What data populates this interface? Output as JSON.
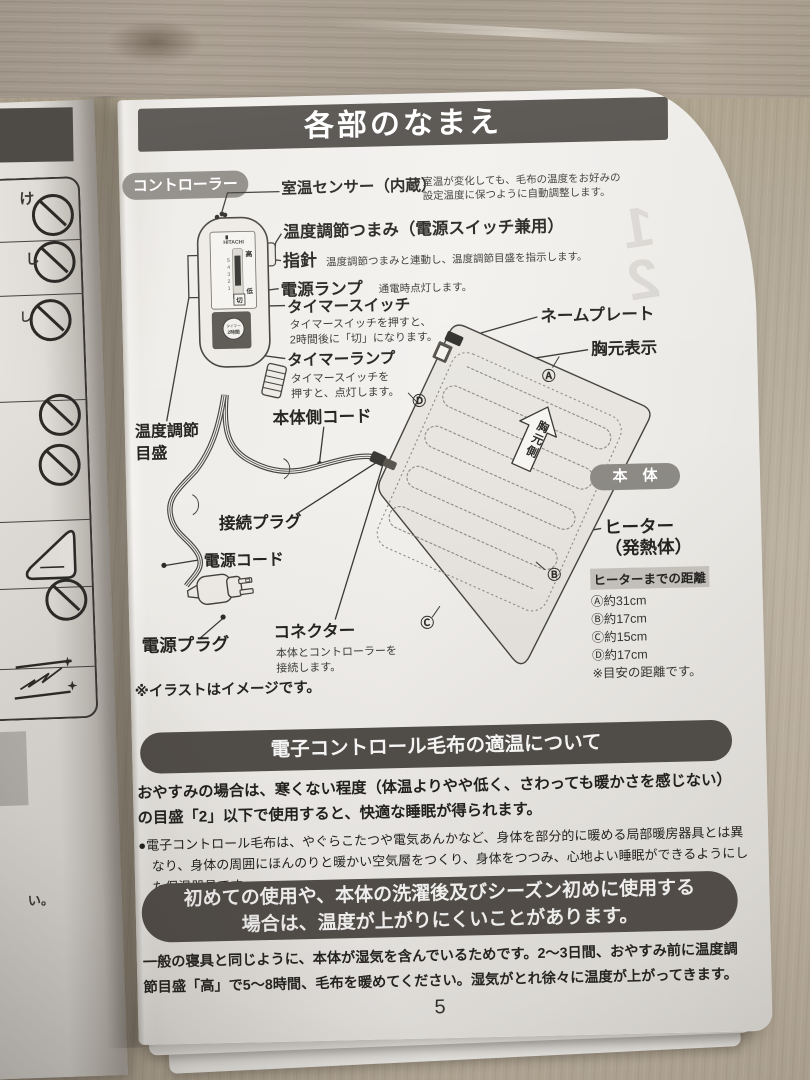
{
  "page": {
    "title": "各部のなまえ",
    "page_number": "5",
    "illustration_note": "※イラストはイメージです。",
    "ghost_digit_1": "1",
    "ghost_digit_2": "2"
  },
  "left_page": {
    "fragment_1": "け",
    "fragment_2": "し",
    "fragment_3": "し",
    "fragment_4": "い。"
  },
  "controller": {
    "badge": "コントローラー",
    "device": {
      "brand": "HITACHI",
      "scale_high": "高",
      "scale_low": "低",
      "scale_off": "切",
      "scale_numbers": [
        "5",
        "4",
        "3",
        "2",
        "1"
      ],
      "timer_button_line1": "タイマー",
      "timer_button_line2": "2時間"
    },
    "parts": {
      "room_sensor": {
        "name": "室温センサー（内蔵）",
        "desc": "室温が変化しても、毛布の温度をお好みの\n設定温度に保つように自動調整します。"
      },
      "temp_knob": {
        "name": "温度調節つまみ（電源スイッチ兼用）"
      },
      "pointer": {
        "name": "指針",
        "desc": "温度調節つまみと連動し、温度調節目盛を指示します。"
      },
      "power_lamp": {
        "name": "電源ランプ",
        "desc": "通電時点灯します。"
      },
      "timer_switch": {
        "name": "タイマースイッチ",
        "desc": "タイマースイッチを押すと、\n2時間後に「切」になります。"
      },
      "timer_lamp": {
        "name": "タイマーランプ",
        "desc": "タイマースイッチを\n押すと、点灯します。"
      },
      "temp_scale": {
        "name": "温度調節\n目盛"
      },
      "body_cord": {
        "name": "本体側コード"
      },
      "connect_plug": {
        "name": "接続プラグ"
      },
      "power_cord": {
        "name": "電源コード"
      },
      "power_plug": {
        "name": "電源プラグ"
      },
      "connector": {
        "name": "コネクター",
        "desc": "本体とコントローラーを\n接続します。"
      }
    }
  },
  "blanket": {
    "badge": "本　体",
    "parts": {
      "nameplate": "ネームプレート",
      "chest_mark": "胸元表示",
      "chest_side_arrow": "胸元側",
      "heater": "ヒーター\n（発熱体）"
    },
    "markers": {
      "a": "Ⓐ",
      "b": "Ⓑ",
      "c": "Ⓒ",
      "d": "Ⓓ"
    },
    "distances": {
      "title": "ヒーターまでの距離",
      "items": [
        "Ⓐ約31cm",
        "Ⓑ約17cm",
        "Ⓒ約15cm",
        "Ⓓ約17cm"
      ],
      "note": "※目安の距離です。"
    }
  },
  "info_sections": {
    "suitable_temp": {
      "title": "電子コントロール毛布の適温について",
      "paragraph": "おやすみの場合は、寒くない程度（体温よりやや低く、さわっても暖かさを感じない）の目盛「2」以下で使用すると、快適な睡眠が得られます。",
      "bullet": "●電子コントロール毛布は、やぐらこたつや電気あんかなど、身体を部分的に暖める局部暖房器具とは異なり、身体の周囲にほんのりと暖かい空気層をつくり、身体をつつみ、心地よい睡眠ができるようにした保温器具です。"
    },
    "first_use": {
      "title": "初めての使用や、本体の洗濯後及びシーズン初めに使用する\n場合は、温度が上がりにくいことがあります。",
      "body": "一般の寝具と同じように、本体が湿気を含んでいるためです。2〜3日間、おやすみ前に温度調節目盛「高」で5〜8時間、毛布を暖めてください。湿気がとれ徐々に温度が上がってきます。"
    }
  },
  "colors": {
    "banner": "#4f4b47",
    "badge": "#8d8a85",
    "paper": "#f2f0ec",
    "ink": "#23221f"
  }
}
